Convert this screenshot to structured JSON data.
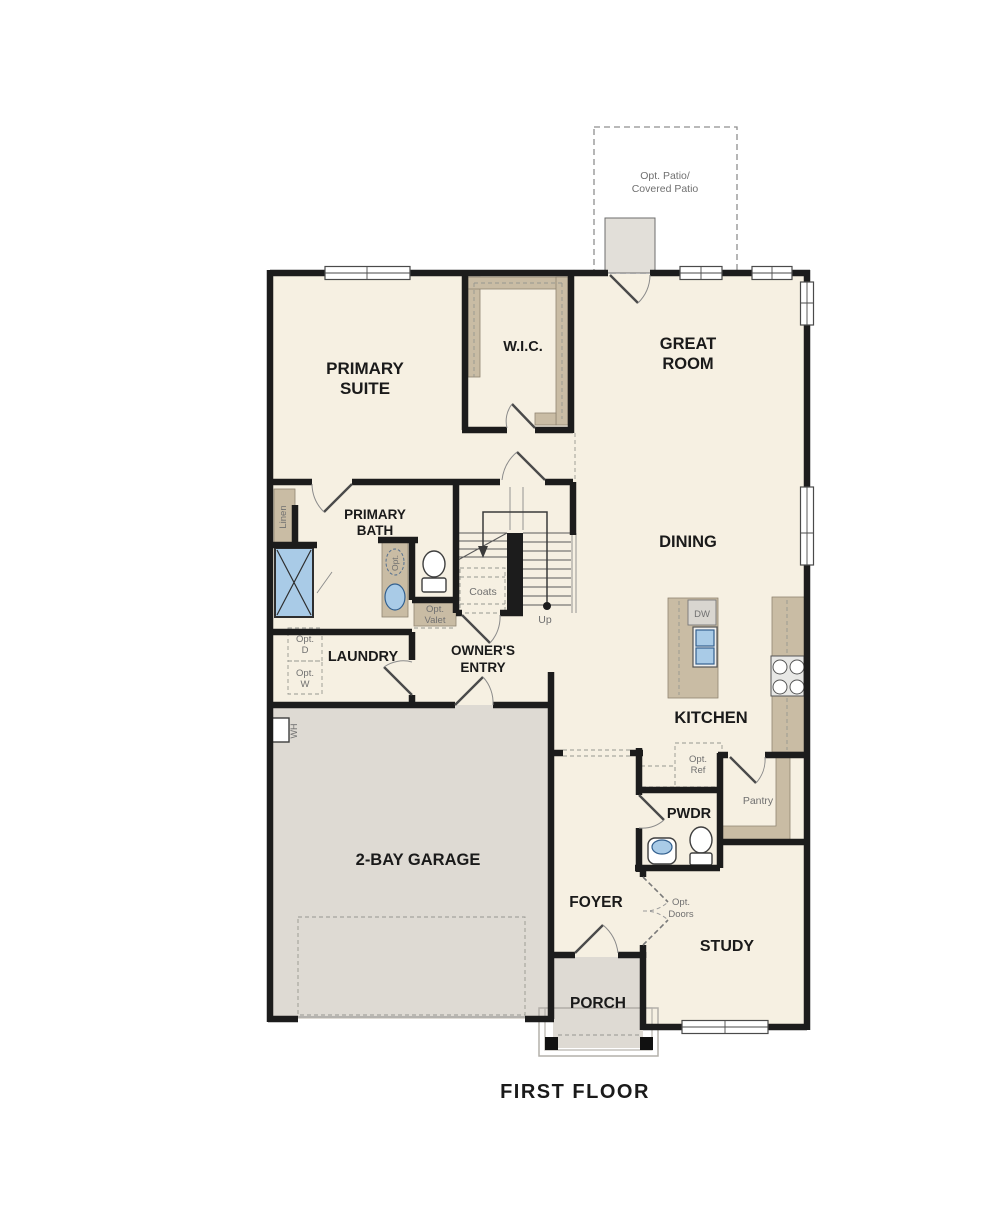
{
  "title": "FIRST FLOOR",
  "rooms": {
    "primary_suite": {
      "line1": "PRIMARY",
      "line2": "SUITE"
    },
    "wic": {
      "label": "W.I.C."
    },
    "great_room": {
      "line1": "GREAT",
      "line2": "ROOM"
    },
    "dining": {
      "label": "DINING"
    },
    "kitchen": {
      "label": "KITCHEN"
    },
    "primary_bath": {
      "line1": "PRIMARY",
      "line2": "BATH"
    },
    "laundry": {
      "label": "LAUNDRY"
    },
    "owners_entry": {
      "line1": "OWNER'S",
      "line2": "ENTRY"
    },
    "garage": {
      "label": "2-BAY GARAGE"
    },
    "pwdr": {
      "label": "PWDR"
    },
    "foyer": {
      "label": "FOYER"
    },
    "study": {
      "label": "STUDY"
    },
    "porch": {
      "label": "PORCH"
    },
    "pantry": {
      "label": "Pantry"
    }
  },
  "annotations": {
    "opt_patio": {
      "line1": "Opt. Patio/",
      "line2": "Covered Patio"
    },
    "linen": "Linen",
    "coats": "Coats",
    "up": "Up",
    "dw": "DW",
    "wh": "WH",
    "opt_sink": "Opt.",
    "opt_valet": {
      "line1": "Opt.",
      "line2": "Valet"
    },
    "opt_ref": {
      "line1": "Opt.",
      "line2": "Ref"
    },
    "opt_d": {
      "line1": "Opt.",
      "line2": "D"
    },
    "opt_w": {
      "line1": "Opt.",
      "line2": "W"
    },
    "opt_doors": {
      "line1": "Opt.",
      "line2": "Doors"
    }
  },
  "palette": {
    "floor": "#f6f0e2",
    "slab": "#dedad3",
    "patio": "#e2dfd9",
    "casework": "#c9bca4",
    "fixture_blue": "#a9cbe7",
    "wall": "#1c1c1c",
    "room_label": "#1a1a1a",
    "annotation_label": "#707070"
  }
}
